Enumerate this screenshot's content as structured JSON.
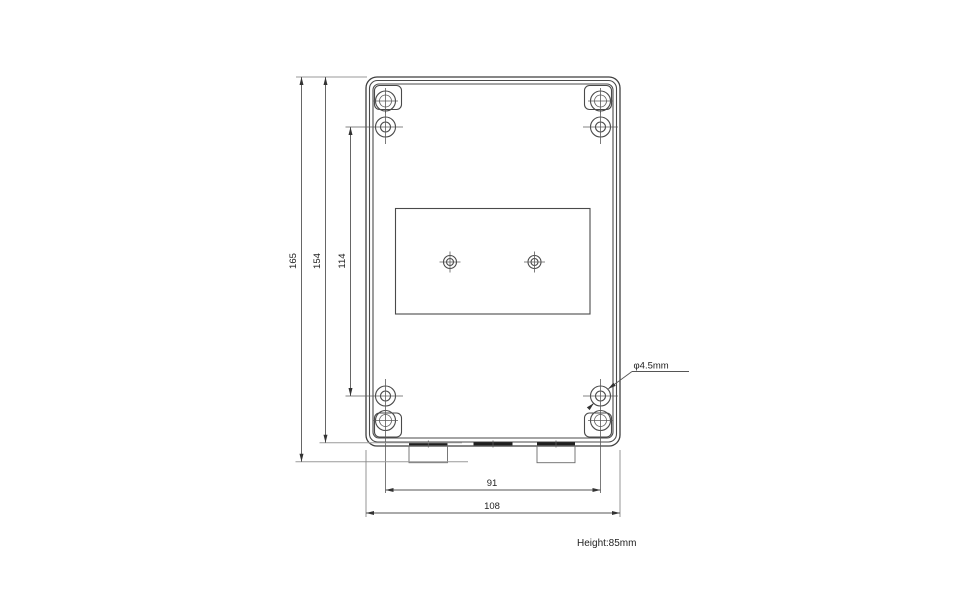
{
  "dimensions": {
    "overall_height": "165",
    "body_height": "154",
    "vertical_hole_spacing": "114",
    "horizontal_hole_spacing": "91",
    "overall_width": "108",
    "hole_diameter": "φ4.5mm",
    "depth_note": "Height:85mm"
  },
  "colors": {
    "background": "#ffffff",
    "outline": "#4a4a4a",
    "dimension_line": "#555555",
    "extension_line": "#9a9a9a",
    "text": "#222222"
  }
}
